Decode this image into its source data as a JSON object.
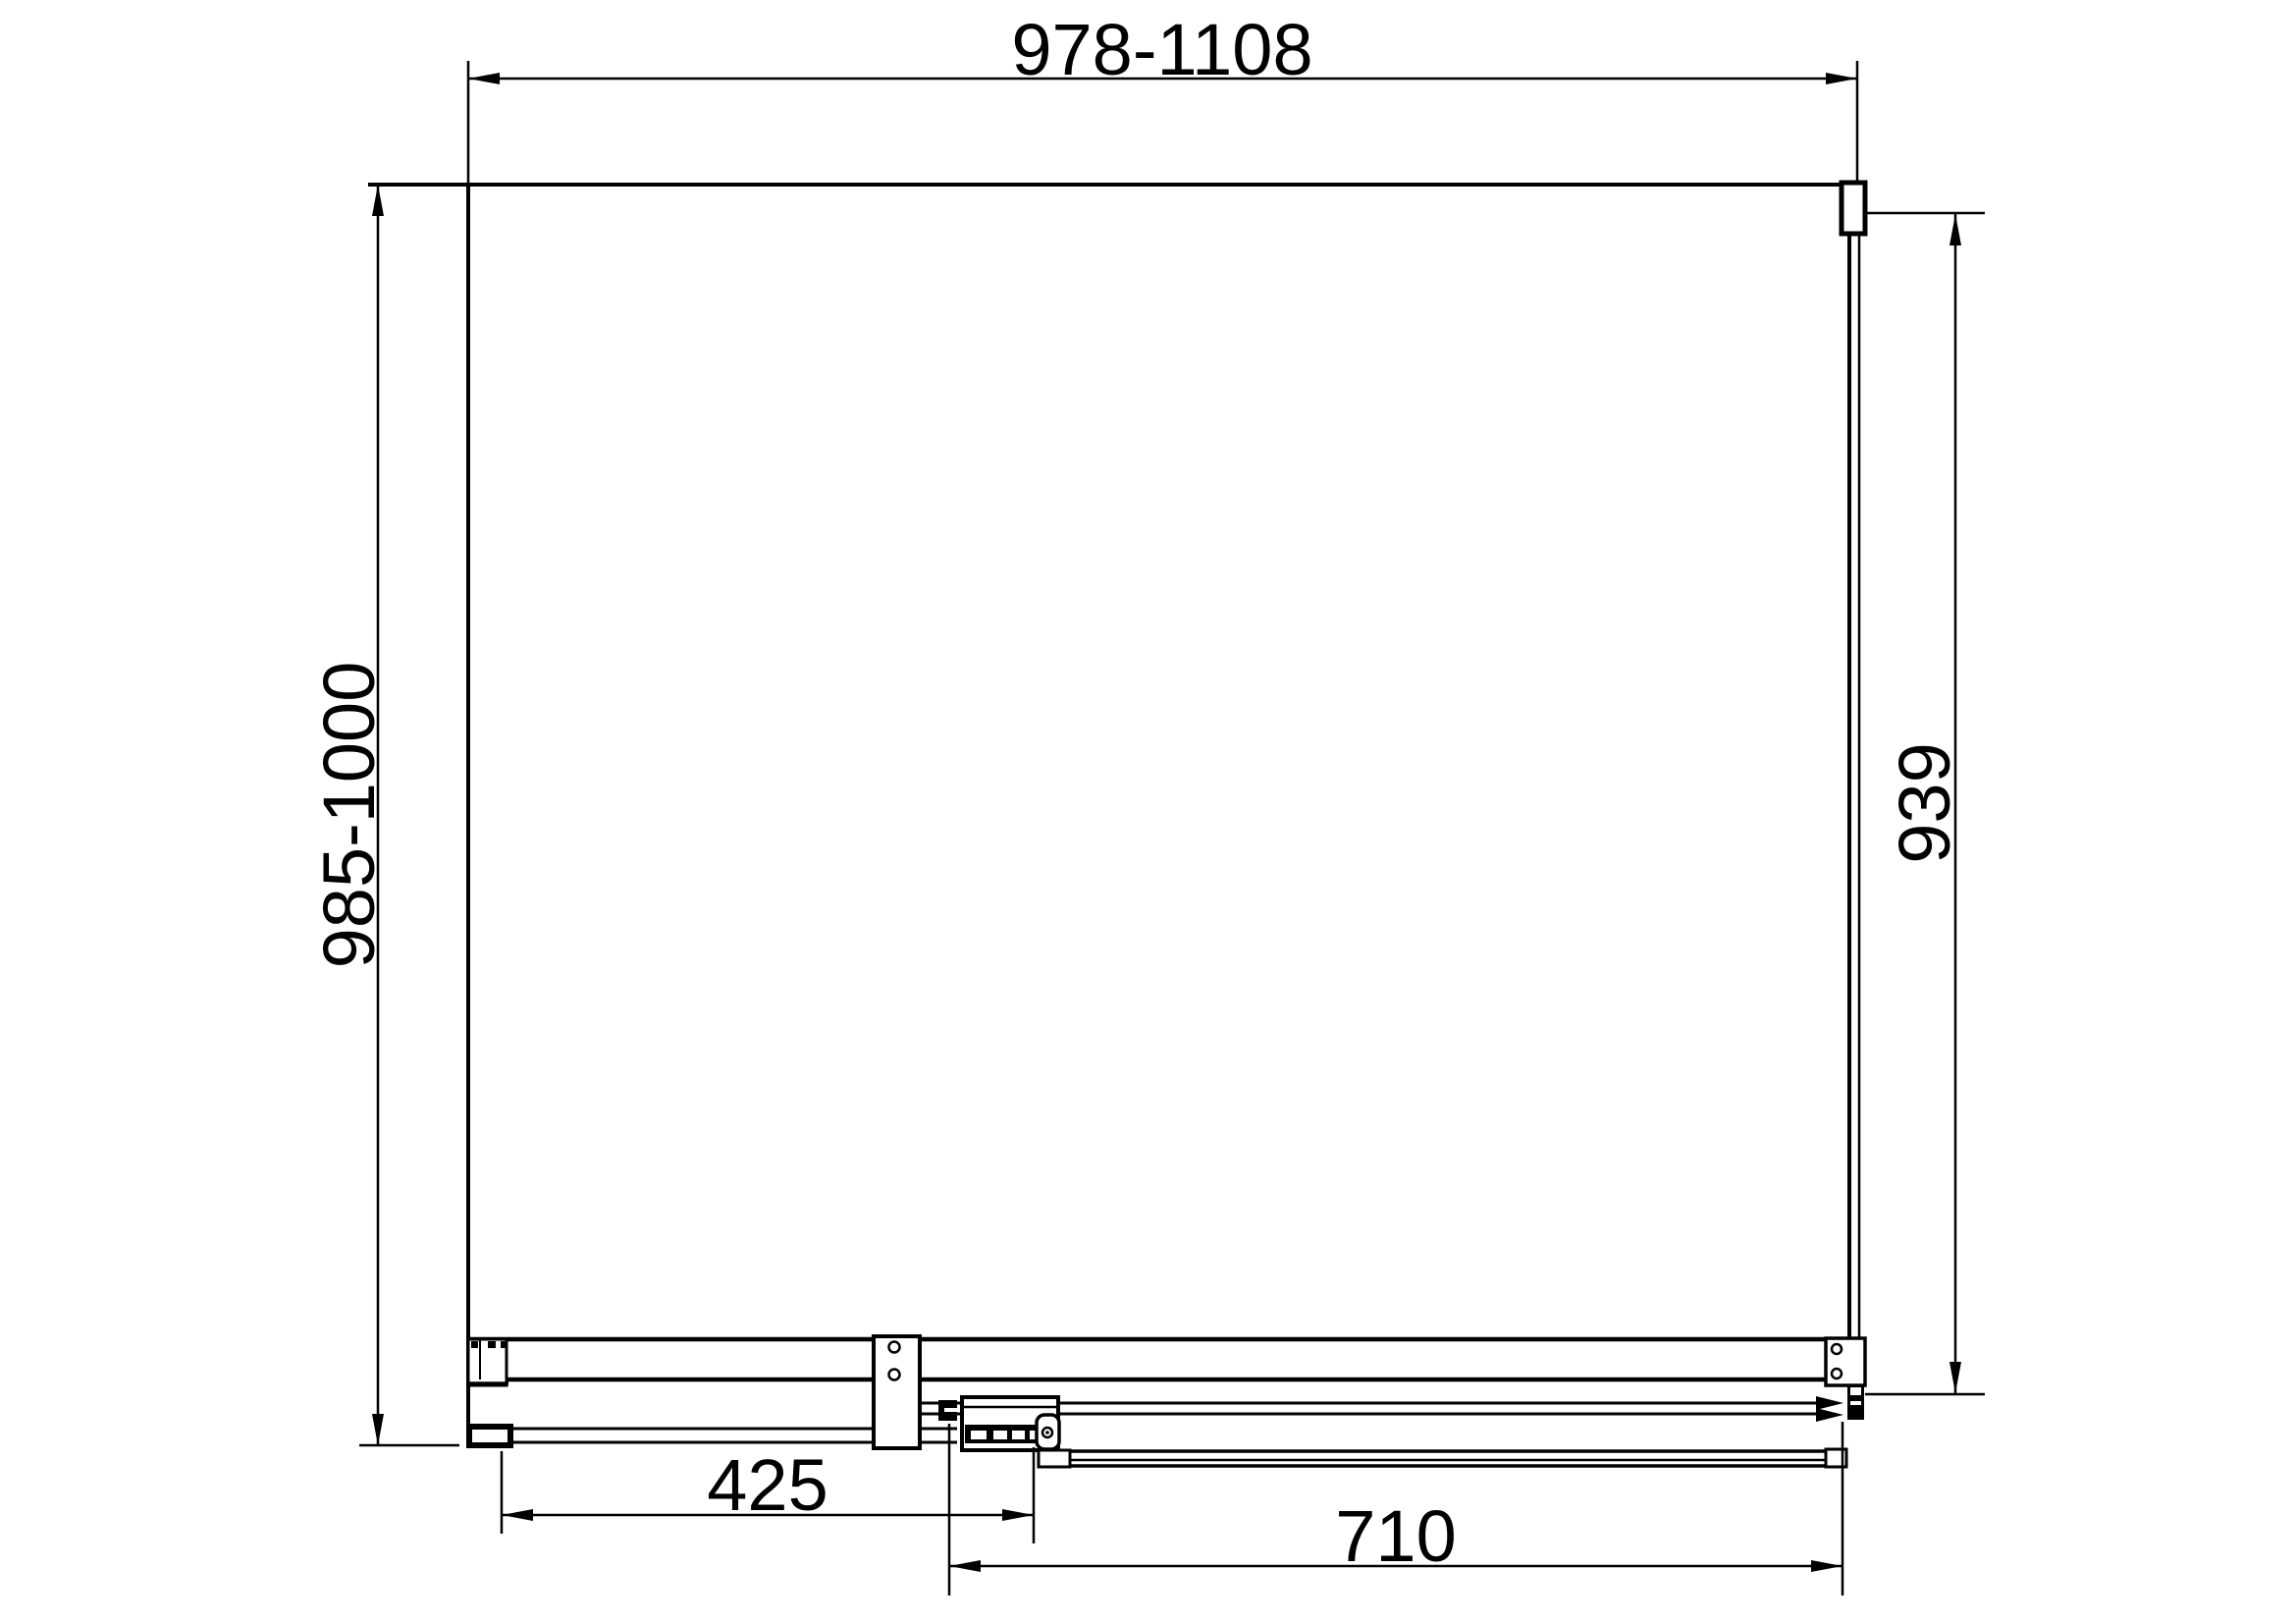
{
  "drawing": {
    "type": "technical-dimension-drawing",
    "subject": "sliding-door-enclosure-plan-view",
    "colors": {
      "line": "#000000",
      "background": "#ffffff"
    },
    "dimensions": {
      "top_width": {
        "label": "978-1108",
        "orientation": "horizontal"
      },
      "left_depth": {
        "label": "985-1000",
        "orientation": "vertical"
      },
      "right_glass": {
        "label": "939",
        "orientation": "vertical"
      },
      "fixed_panel": {
        "label": "425",
        "orientation": "horizontal"
      },
      "sliding_door": {
        "label": "710",
        "orientation": "horizontal"
      }
    }
  }
}
